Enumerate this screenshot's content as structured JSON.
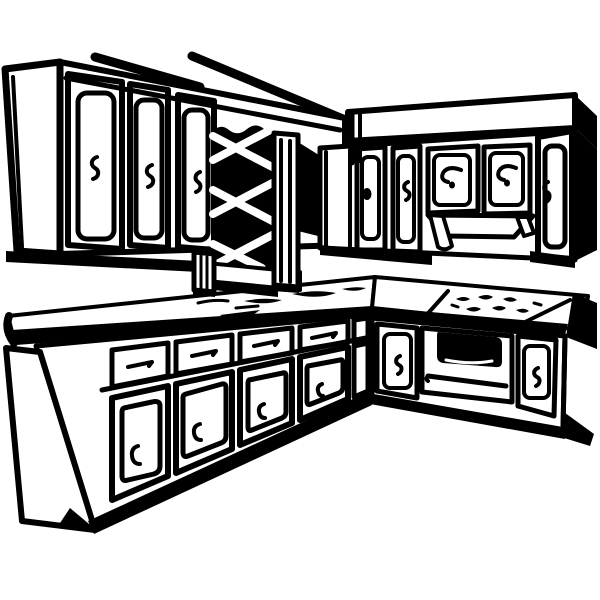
{
  "image": {
    "kind": "clip-art line illustration",
    "subject": "L-shaped kitchen corner with upper and lower cabinets",
    "style": "retro black ink outlines on plain white background",
    "background_color": "#ffffff",
    "ink_color": "#000000",
    "elements": {
      "ceiling_trim": "two sketchy diagonal soffit lines above the left cabinet run",
      "upper_cabinets_left": "three tall cupboard doors with small squiggle handles",
      "lattice_window": "black diamond-lattice panel framed by slatted posts and a sill",
      "upper_cabinets_right": "soffit-topped cupboard run with scroll-handle doors and tall end door",
      "range_hood_valance": "arched trapezoid valance with side feet under the center cupboards",
      "countertop": "L-shaped counter with heavy black front edge and end caps",
      "counter_marks": "loose ink smudges suggesting a sink area near the corner",
      "cooktop_burners": "scribbled burner blobs on the right counter",
      "oven": "oven front with dark rounded window and long handle bar",
      "base_cabinets_left": "five bays of drawers above panel doors with bracket handles",
      "base_cabinets_right": "panel doors flanking the oven",
      "toe_kick": "thick black shadow band along the cabinet bases"
    }
  }
}
